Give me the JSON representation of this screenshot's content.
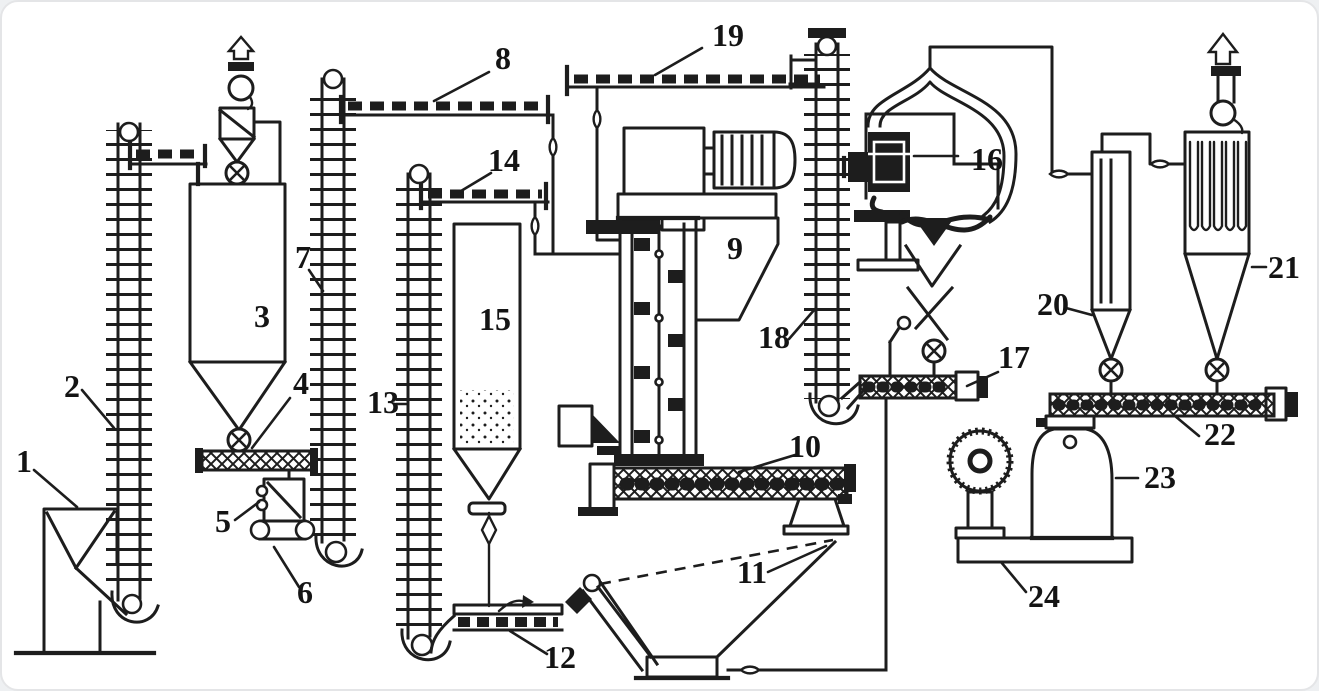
{
  "diagram": {
    "type": "process-flow-diagram",
    "description_visible_text_only": true,
    "labels": [
      "1",
      "2",
      "3",
      "4",
      "5",
      "6",
      "7",
      "8",
      "9",
      "10",
      "11",
      "12",
      "13",
      "14",
      "15",
      "16",
      "17",
      "18",
      "19",
      "20",
      "21",
      "22",
      "23",
      "24"
    ],
    "colors": {
      "ink": "#1d1d1d",
      "background": "#ffffff",
      "frame": "#e4e5e7"
    }
  }
}
